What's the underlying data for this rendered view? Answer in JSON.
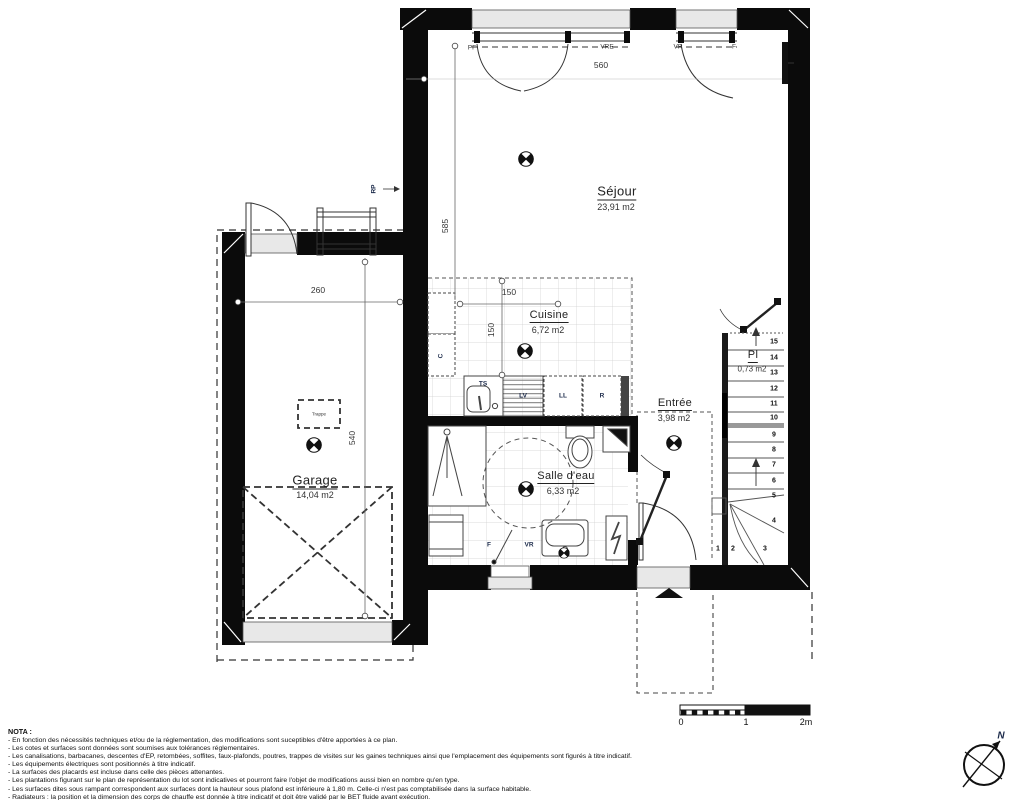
{
  "colors": {
    "wall": "#0b0b0b",
    "sill": "#e8e8e8",
    "tile_line": "#cfcfcf",
    "equipment_text": "#1b2a4a",
    "ink": "#222222"
  },
  "rooms": {
    "sejour": {
      "name": "Séjour",
      "area": "23,91 m2"
    },
    "cuisine": {
      "name": "Cuisine",
      "area": "6,72 m2"
    },
    "salle_deau": {
      "name": "Salle d'eau",
      "area": "6,33 m2"
    },
    "entree": {
      "name": "Entrée",
      "area": "3,98 m2"
    },
    "garage": {
      "name": "Garage",
      "area": "14,04 m2"
    },
    "placard": {
      "name": "Pl",
      "area": "0,73 m2"
    }
  },
  "dimensions": {
    "bay": "560",
    "sejour_depth": "585",
    "cuisine_w": "150",
    "cuisine_d": "150",
    "garage_w": "260",
    "garage_d": "540"
  },
  "openings": {
    "pf": "PF",
    "vre": "VRE",
    "vr": "VR",
    "f": "F",
    "window_f": "F",
    "window_vr": "VR"
  },
  "equipment": {
    "rp": "RP",
    "c": "C",
    "ts": "TS",
    "lv": "LV",
    "ll": "LL",
    "r": "R",
    "trappe": "Trappe"
  },
  "stairs": {
    "steps": [
      "1",
      "2",
      "3",
      "4",
      "5",
      "6",
      "7",
      "8",
      "9",
      "10",
      "11",
      "12",
      "13",
      "14",
      "15"
    ]
  },
  "scale_bar": {
    "zero": "0",
    "one": "1",
    "two": "2m"
  },
  "compass": {
    "north": "N"
  },
  "nota": {
    "title": "NOTA :",
    "lines": [
      "- En fonction des nécessités techniques et/ou de la réglementation, des modifications sont suceptibles d'être apportées à ce plan.",
      "- Les cotes et surfaces sont données sont soumises aux tolérances réglementaires.",
      "- Les canalisations, barbacanes, descentes d'EP, retombées, soffites, faux-plafonds, poutres, trappes de visites sur les gaines techniques ainsi que l'emplacement des équipements sont figurés à titre indicatif.",
      "- Les équipements électriques sont positionnés à titre indicatif.",
      "- La surfaces des placards est incluse dans celle des pièces attenantes.",
      "- Les plantations figurant sur le plan de représentation du lot sont indicatives et pourront faire l'objet de modifications aussi bien en nombre qu'en type.",
      "- Les surfaces dites sous rampant correspondent aux surfaces dont la hauteur sous plafond est inférieure à 1,80 m. Celle-ci n'est pas comptabilisée dans la surface habitable.",
      "- Radiateurs : la position et la dimension des corps de chauffe est donnée à titre indicatif et doit être validé par le BET fluide avant exécution."
    ]
  }
}
